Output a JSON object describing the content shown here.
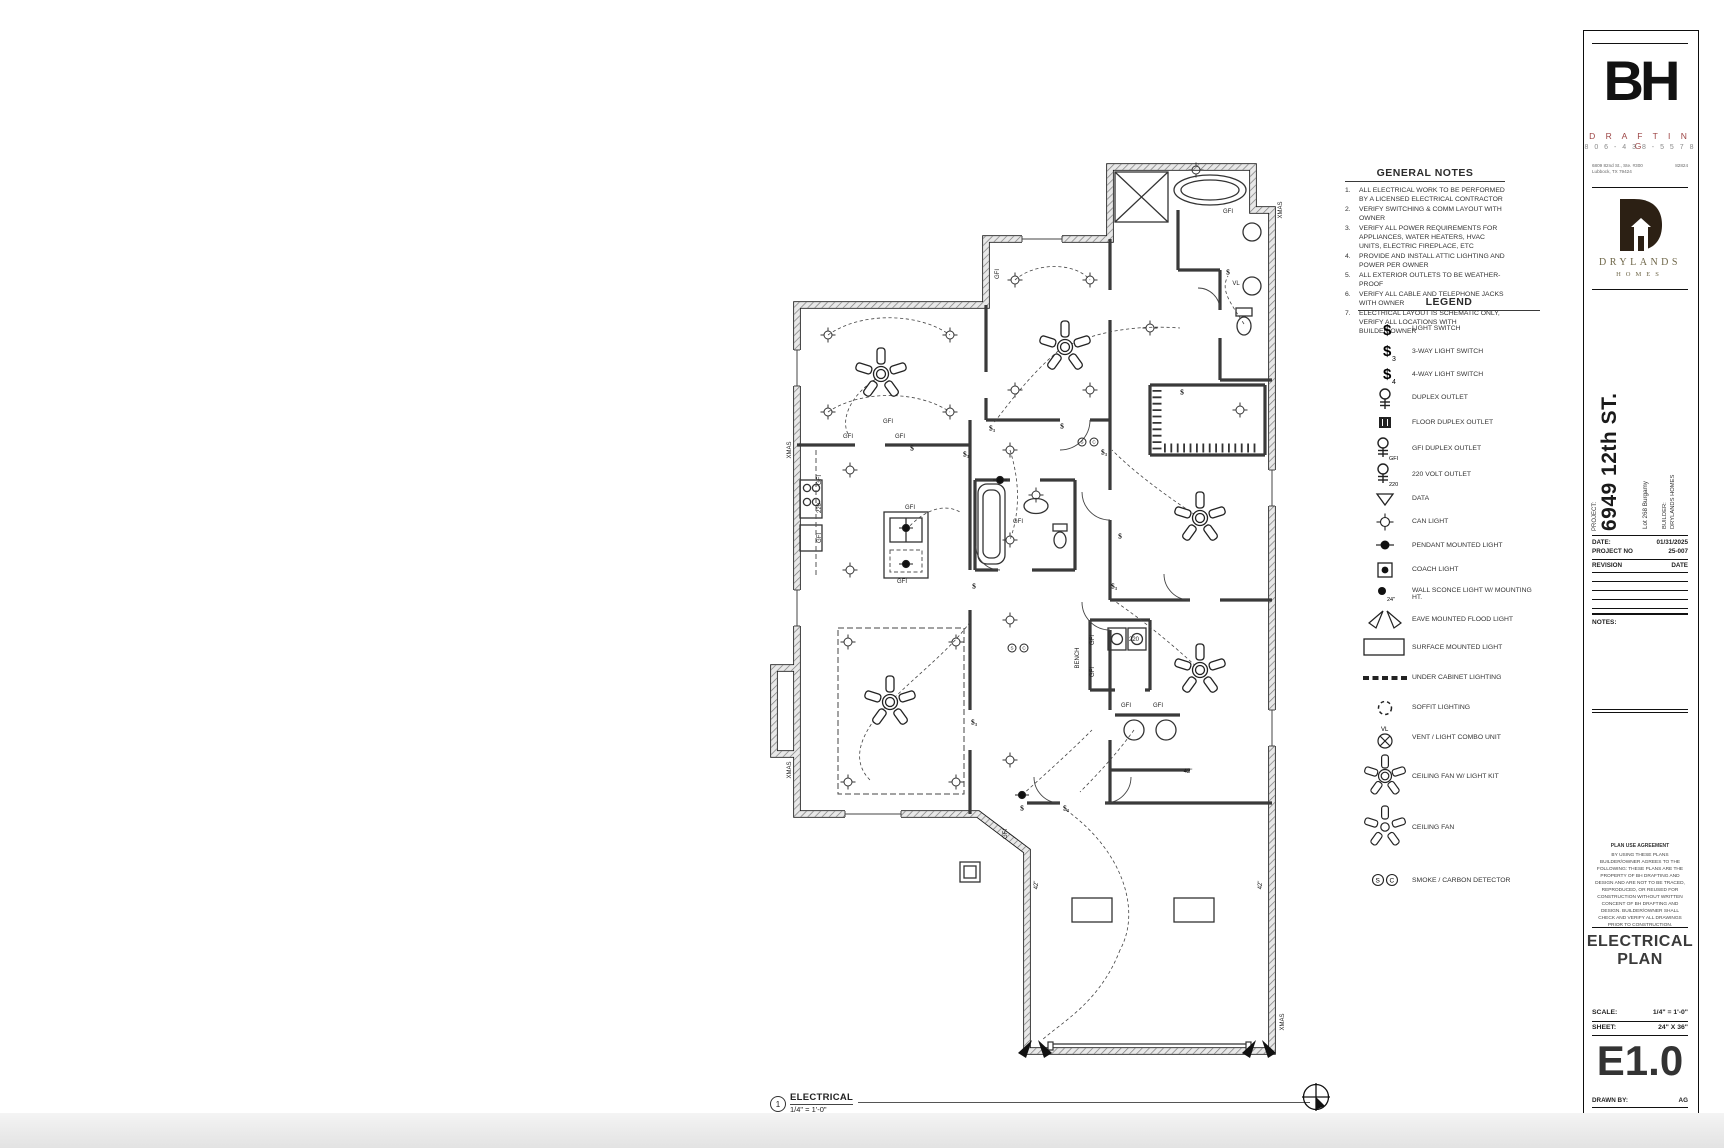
{
  "general_notes": {
    "title": "GENERAL NOTES",
    "items": [
      {
        "n": "1.",
        "t": "ALL ELECTRICAL WORK TO BE PERFORMED BY A LICENSED ELECTRICAL CONTRACTOR"
      },
      {
        "n": "2.",
        "t": "VERIFY SWITCHING & COMM LAYOUT WITH OWNER"
      },
      {
        "n": "3.",
        "t": "VERIFY ALL POWER REQUIREMENTS FOR APPLIANCES, WATER HEATERS, HVAC UNITS, ELECTRIC FIREPLACE, ETC"
      },
      {
        "n": "4.",
        "t": "PROVIDE AND INSTALL ATTIC LIGHTING AND POWER PER OWNER"
      },
      {
        "n": "5.",
        "t": "ALL EXTERIOR OUTLETS TO BE WEATHER-PROOF"
      },
      {
        "n": "6.",
        "t": "VERIFY ALL CABLE AND TELEPHONE JACKS WITH OWNER"
      },
      {
        "n": "7.",
        "t": "ELECTRICAL LAYOUT IS SCHEMATIC ONLY, VERIFY ALL LOCATIONS WITH BUILDER/OWNER"
      }
    ]
  },
  "legend": {
    "title": "LEGEND",
    "dollar": "$",
    "sub3": "3",
    "sub4": "4",
    "gfi": "GFI",
    "v220": "220",
    "ht24": "24\"",
    "vl": "VL",
    "smoke_s": "S",
    "smoke_c": "C",
    "items": [
      {
        "label": "LIGHT SWITCH"
      },
      {
        "label": "3-WAY LIGHT SWITCH"
      },
      {
        "label": "4-WAY LIGHT SWITCH"
      },
      {
        "label": "DUPLEX OUTLET"
      },
      {
        "label": "FLOOR DUPLEX OUTLET"
      },
      {
        "label": "GFI DUPLEX OUTLET"
      },
      {
        "label": "220 VOLT OUTLET"
      },
      {
        "label": "DATA"
      },
      {
        "label": "CAN LIGHT"
      },
      {
        "label": "PENDANT MOUNTED LIGHT"
      },
      {
        "label": "COACH LIGHT"
      },
      {
        "label": "WALL SCONCE LIGHT W/ MOUNTING HT."
      },
      {
        "label": "EAVE MOUNTED FLOOD LIGHT"
      },
      {
        "label": "SURFACE MOUNTED LIGHT"
      },
      {
        "label": "UNDER CABINET LIGHTING"
      },
      {
        "label": "SOFFIT LIGHTING"
      },
      {
        "label": "VENT / LIGHT COMBO UNIT"
      },
      {
        "label": "CEILING FAN W/ LIGHT KIT"
      },
      {
        "label": "CEILING FAN"
      },
      {
        "label": "SMOKE / CARBON DETECTOR"
      }
    ]
  },
  "drawing_label": {
    "number": "1",
    "title": "ELECTRICAL",
    "scale": "1/4\" = 1'-0\""
  },
  "north_label": "N",
  "plan": {
    "annotations": [
      {
        "t": "GFI",
        "x": 88,
        "y": 287
      },
      {
        "t": "GFI",
        "x": 140,
        "y": 287
      },
      {
        "t": "GFI",
        "x": 128,
        "y": 272
      },
      {
        "t": "GFI",
        "x": 150,
        "y": 358
      },
      {
        "t": "GFI",
        "x": 142,
        "y": 432
      },
      {
        "t": "GFI",
        "x": 60,
        "y": 330,
        "v": 1
      },
      {
        "t": "220",
        "x": 60,
        "y": 358,
        "v": 1
      },
      {
        "t": "GFI",
        "x": 60,
        "y": 388,
        "v": 1
      },
      {
        "t": "GFI",
        "x": 468,
        "y": 62
      },
      {
        "t": "GFI",
        "x": 258,
        "y": 372
      },
      {
        "t": "GFI",
        "x": 366,
        "y": 556
      },
      {
        "t": "GFI",
        "x": 398,
        "y": 556
      },
      {
        "t": "GFI",
        "x": 333,
        "y": 490,
        "v": 1
      },
      {
        "t": "GFI",
        "x": 333,
        "y": 522,
        "v": 1
      },
      {
        "t": "220",
        "x": 374,
        "y": 490
      },
      {
        "t": "GFI",
        "x": 238,
        "y": 124,
        "v": 1
      },
      {
        "t": "GFI",
        "x": 246,
        "y": 684,
        "v": 1
      },
      {
        "t": "XMAS",
        "x": 30,
        "y": 300,
        "v": 1
      },
      {
        "t": "XMAS",
        "x": 30,
        "y": 620,
        "v": 1
      },
      {
        "t": "XMAS",
        "x": 521,
        "y": 60,
        "v": 1
      },
      {
        "t": "XMAS",
        "x": 523,
        "y": 872,
        "v": 1
      },
      {
        "t": "42\"",
        "x": 277,
        "y": 735,
        "v": 1
      },
      {
        "t": "42\"",
        "x": 501,
        "y": 735,
        "v": 1
      },
      {
        "t": "42\"",
        "x": 428,
        "y": 622
      },
      {
        "t": "BENCH",
        "x": 318,
        "y": 508,
        "v": 1
      },
      {
        "t": "VL",
        "x": 476,
        "y": 134
      },
      {
        "t": "$",
        "x": 152,
        "y": 298,
        "c": "sw"
      },
      {
        "t": "$₃",
        "x": 206,
        "y": 304,
        "c": "sw"
      },
      {
        "t": "$₃",
        "x": 232,
        "y": 278,
        "c": "sw"
      },
      {
        "t": "$",
        "x": 302,
        "y": 276,
        "c": "sw"
      },
      {
        "t": "$₃",
        "x": 344,
        "y": 302,
        "c": "sw"
      },
      {
        "t": "$",
        "x": 422,
        "y": 242,
        "c": "sw"
      },
      {
        "t": "$₃",
        "x": 354,
        "y": 436,
        "c": "sw"
      },
      {
        "t": "$",
        "x": 214,
        "y": 436,
        "c": "sw"
      },
      {
        "t": "$₃",
        "x": 214,
        "y": 572,
        "c": "sw"
      },
      {
        "t": "$",
        "x": 262,
        "y": 658,
        "c": "sw"
      },
      {
        "t": "$₃",
        "x": 306,
        "y": 658,
        "c": "sw"
      },
      {
        "t": "$",
        "x": 468,
        "y": 122,
        "c": "sw"
      },
      {
        "t": "$",
        "x": 360,
        "y": 386,
        "c": "sw"
      },
      {
        "t": "S",
        "x": 322,
        "y": 292,
        "c": "circ"
      },
      {
        "t": "C",
        "x": 334,
        "y": 292,
        "c": "circ"
      },
      {
        "t": "S",
        "x": 252,
        "y": 498,
        "c": "circ"
      },
      {
        "t": "C",
        "x": 264,
        "y": 498,
        "c": "circ"
      }
    ]
  },
  "title_block": {
    "bh": {
      "word": "BH",
      "drafting": "D R A F T I N G",
      "phone": "8 0 6 - 4 3 8 - 5 5 7 8",
      "addr1": "6809 82nd St., Ste. #300",
      "addr2": "Lubbock, TX 79424",
      "addr_right": "82824",
      "accent": "#9c4444"
    },
    "drylands": {
      "name": "DRYLANDS",
      "homes": "HOMES",
      "name_color": "#6e6648",
      "logo_color": "#2c2014"
    },
    "project": {
      "label": "PROJECT:",
      "name": "6949 12th ST.",
      "lot": "Lot 268 Burgamy",
      "builder_label": "BUILDER:",
      "builder": "DRYLANDS HOMES"
    },
    "meta": {
      "date_label": "DATE:",
      "date": "01/31/2025",
      "pno_label": "PROJECT NO",
      "pno": "25-007",
      "rev_label": "REVISION",
      "rev_date_label": "DATE"
    },
    "notes_label": "NOTES:",
    "plan_use": {
      "title": "PLAN USE AGREEMENT",
      "body": "BY USING THESE PLANS BUILDER/OWNER AGREES TO THE FOLLOWING: THESE PLANS ARE THE PROPERTY OF BH DRAFTING AND DESIGN AND ARE NOT TO BE TRACED, REPRODUCED, OR REUSED FOR CONSTRUCTION WITHOUT WRITTEN CONCENT OF BH DRAFTING AND DESIGN. BUILDER/OWNER SHALL CHECK AND VERIFY ALL DRAWINGS PRIOR TO CONSTRUCTION."
    },
    "sheet_title_1": "ELECTRICAL",
    "sheet_title_2": "PLAN",
    "scale_label": "SCALE:",
    "scale_value": "1/4\" = 1'-0\"",
    "sheet_label": "SHEET:",
    "sheet_value": "24\" X 36\"",
    "sheet_number": "E1.0",
    "drawn_label": "DRAWN BY:",
    "drawn_value": "AG"
  }
}
